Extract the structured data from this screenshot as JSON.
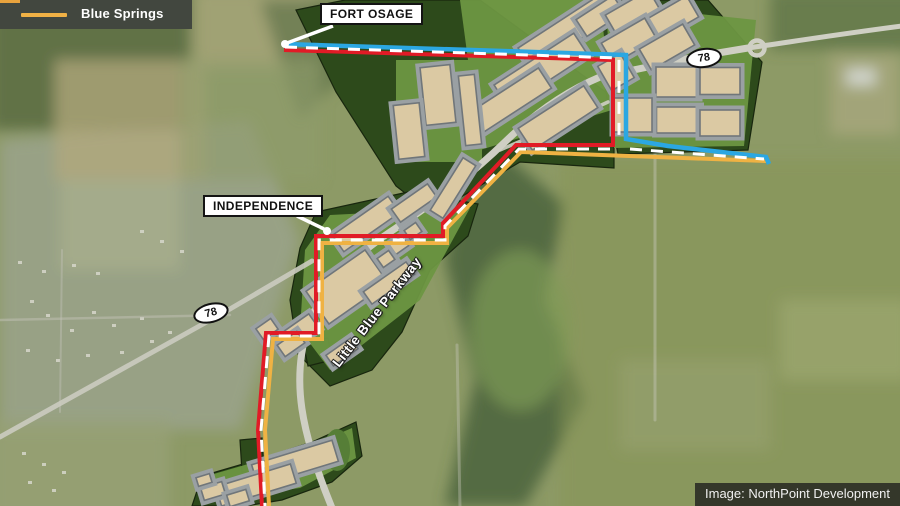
{
  "legend": {
    "items": [
      {
        "label": "Blue Springs",
        "color": "#f0b145"
      }
    ]
  },
  "callouts": {
    "fort_osage": "FORT OSAGE",
    "independence": "INDEPENDENCE"
  },
  "map_text": {
    "parkway": "Little Blue Parkway"
  },
  "shields": {
    "left": "78",
    "right": "78"
  },
  "credit": "Image: NorthPoint Development",
  "colors": {
    "boundary_red": "#e11b26",
    "boundary_blue": "#2ba7e2",
    "boundary_yellow": "#efb243",
    "dash_white": "#ffffff"
  }
}
